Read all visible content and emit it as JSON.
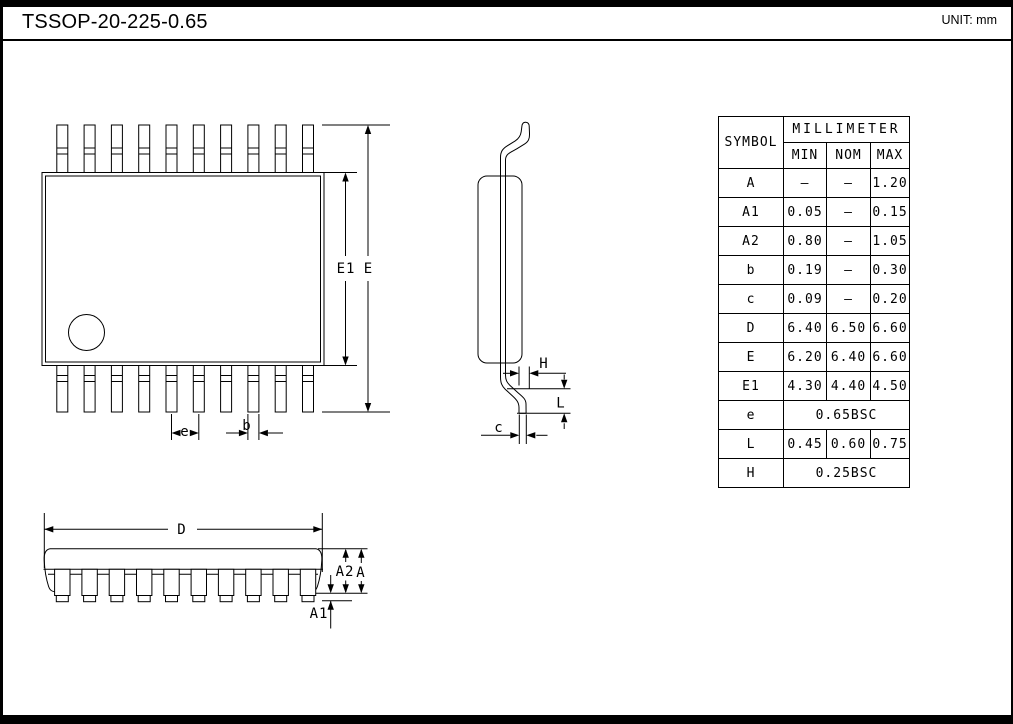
{
  "header": {
    "title": "TSSOP-20-225-0.65",
    "unit": "UNIT: mm"
  },
  "table": {
    "symbol_header": "SYMBOL",
    "unit_header": "MILLIMETER",
    "columns": [
      "MIN",
      "NOM",
      "MAX"
    ],
    "rows": [
      {
        "symbol": "A",
        "min": "—",
        "nom": "—",
        "max": "1.20"
      },
      {
        "symbol": "A1",
        "min": "0.05",
        "nom": "—",
        "max": "0.15"
      },
      {
        "symbol": "A2",
        "min": "0.80",
        "nom": "—",
        "max": "1.05"
      },
      {
        "symbol": "b",
        "min": "0.19",
        "nom": "—",
        "max": "0.30"
      },
      {
        "symbol": "c",
        "min": "0.09",
        "nom": "—",
        "max": "0.20"
      },
      {
        "symbol": "D",
        "min": "6.40",
        "nom": "6.50",
        "max": "6.60"
      },
      {
        "symbol": "E",
        "min": "6.20",
        "nom": "6.40",
        "max": "6.60"
      },
      {
        "symbol": "E1",
        "min": "4.30",
        "nom": "4.40",
        "max": "4.50"
      },
      {
        "symbol": "e",
        "span": "0.65BSC"
      },
      {
        "symbol": "L",
        "min": "0.45",
        "nom": "0.60",
        "max": "0.75"
      },
      {
        "symbol": "H",
        "span": "0.25BSC"
      }
    ]
  },
  "labels": {
    "E1": "E1",
    "E": "E",
    "e": "e",
    "b": "b",
    "H": "H",
    "L": "L",
    "c": "c",
    "D": "D",
    "A2": "A2",
    "A": "A",
    "A1": "A1"
  }
}
